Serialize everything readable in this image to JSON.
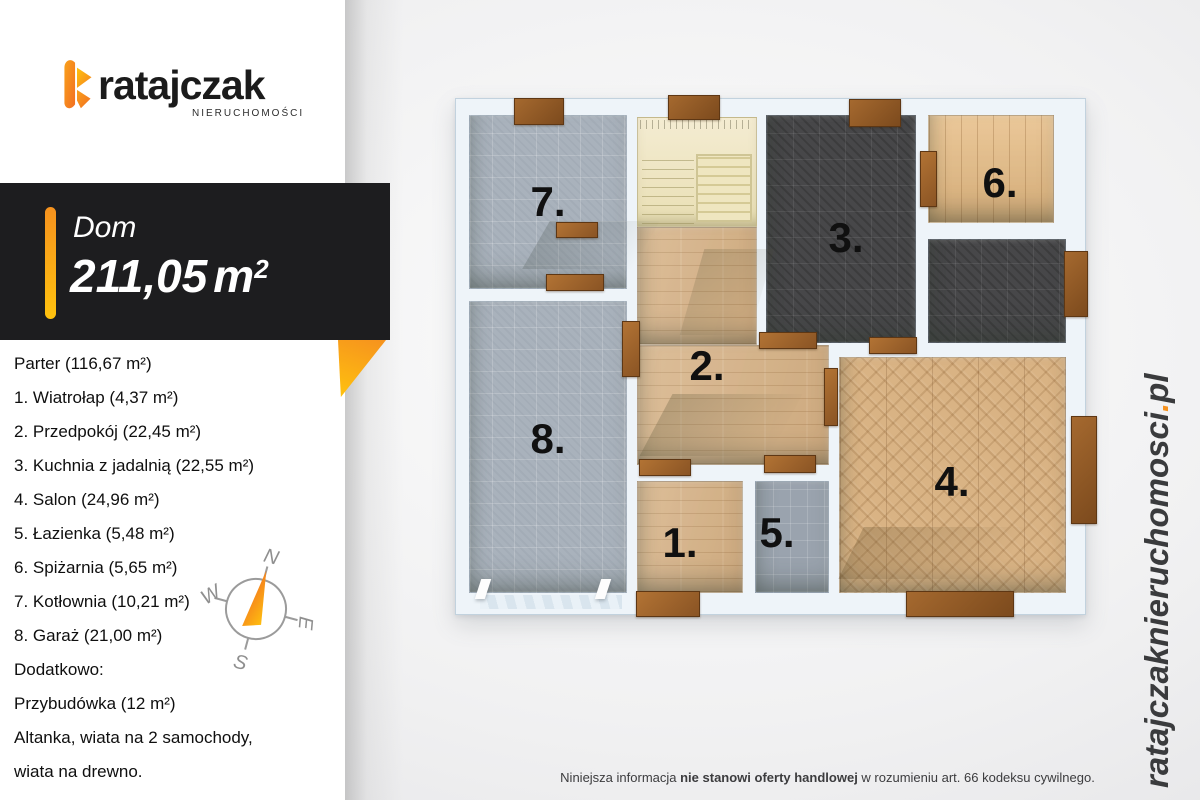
{
  "colors": {
    "accent_orange": "#f6921e",
    "accent_yellow": "#ffc20e",
    "banner_bg": "#1d1d1f",
    "site_text": "#3a3b3d"
  },
  "logo": {
    "brand": "ratajczak",
    "tagline": "NIERUCHOMOŚCI"
  },
  "banner": {
    "property_type": "Dom",
    "area_value": "211,05",
    "area_unit": "m",
    "area_sup": "2"
  },
  "room_list": [
    "Parter (116,67 m²)",
    "1. Wiatrołap (4,37 m²)",
    "2. Przedpokój (22,45 m²)",
    "3. Kuchnia z jadalnią (22,55 m²)",
    "4. Salon (24,96 m²)",
    "5. Łazienka (5,48 m²)",
    "6. Spiżarnia (5,65 m²)",
    "7. Kotłownia (10,21 m²)",
    "8. Garaż (21,00 m²)",
    "Dodatkowo:",
    "Przybudówka (12 m²)",
    "Altanka, wiata na 2 samochody,",
    "wiata na drewno."
  ],
  "compass": {
    "north": "N",
    "west": "W",
    "east": "E",
    "south": "S"
  },
  "plan": {
    "room_numbers": [
      "7.",
      "8.",
      "2.",
      "3.",
      "6.",
      "4.",
      "1.",
      "5."
    ]
  },
  "website": {
    "name": "ratajczaknieruchomosci",
    "dot": ".",
    "tld": "pl"
  },
  "disclaimer": {
    "prefix": "Niniejsza informacja ",
    "bold": "nie stanowi oferty handlowej",
    "suffix": " w rozumieniu art. 66 kodeksu cywilnego."
  }
}
